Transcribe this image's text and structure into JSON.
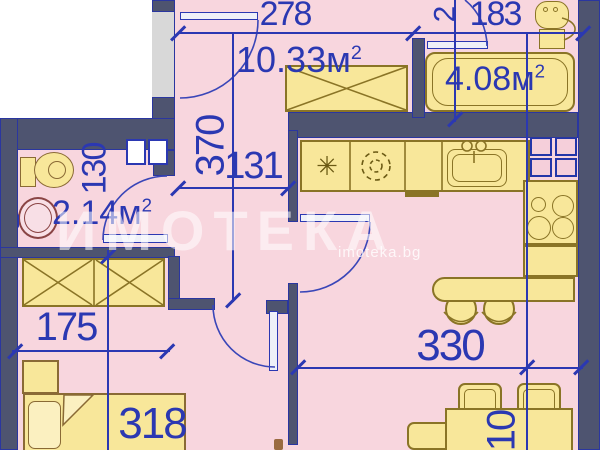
{
  "title": "apartment floor plan",
  "colors": {
    "room_fill": "#f8d6de",
    "furniture_fill": "#f8e79a",
    "furniture_border": "#8a7426",
    "wall_fill": "#4e5470",
    "wall_border": "#2a36a0",
    "dimension_blue": "#2b38b2",
    "outside_dark": "#5a5f75",
    "outside_white": "#ffffff",
    "entry_niche_gray": "#d8d8d8",
    "sink_maroon": "#8a4444",
    "bed_brown": "#8a6a35"
  },
  "rooms": {
    "hallway": {
      "area": "10.33",
      "unit": "м",
      "sup": "2"
    },
    "bathroom_large": {
      "area": "4.08",
      "unit": "м",
      "sup": "2"
    },
    "bathroom_small": {
      "area": "2.14",
      "unit": "м",
      "sup": "2"
    }
  },
  "dimensions": {
    "entry_width": "278",
    "bath_large_width": "183",
    "bath_large_depth": "2",
    "hall_length": "370",
    "hall_width": "131",
    "bath_small_width": "130",
    "wardrobe_width": "175",
    "bed_length": "318",
    "living_width": "330",
    "table_width": "10"
  },
  "icons": {
    "fridge_snowflake": "✳"
  },
  "watermark": {
    "title": "ИМОТЕКА",
    "url": "imoteka.bg"
  }
}
